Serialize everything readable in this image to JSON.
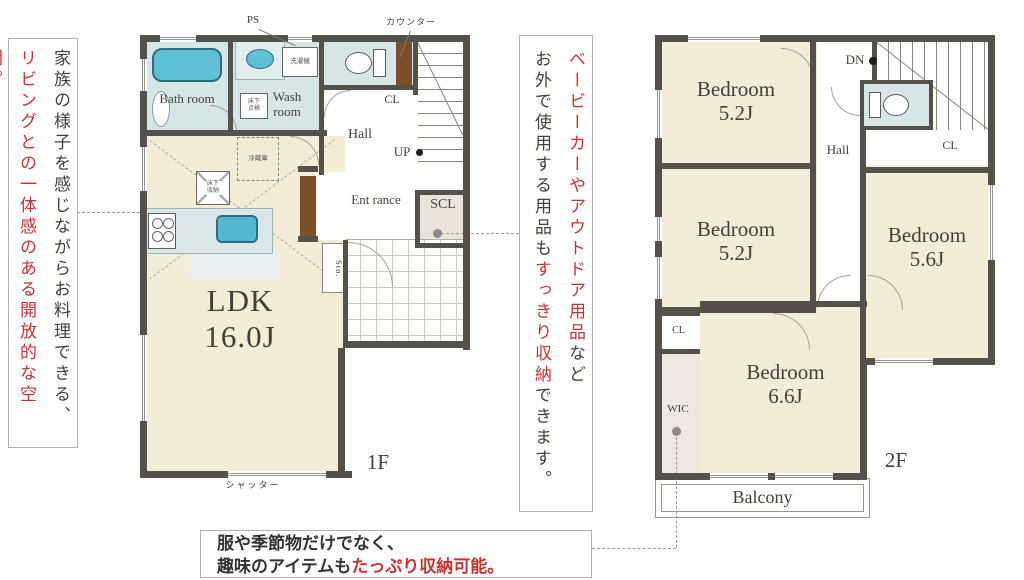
{
  "colors": {
    "wall": "#54504a",
    "room_beige": "#f3ecd7",
    "wet_area_blue": "#d6e5e6",
    "closet_beige": "#ece3d8",
    "fixture_teal": "#5ec1d6",
    "door_brown": "#7c4e2a",
    "accent_red": "#c53333"
  },
  "notes": {
    "left": {
      "black": "家族の様子を感じながらお料理できる、",
      "red": "リビングとの一体感のある開放的な空間。"
    },
    "middle": {
      "red1": "ベービーカーやアウトドア用品",
      "black1": "など",
      "black2": "お外で使用する用品も",
      "red2": "すっきり収納",
      "black3": "できます。"
    },
    "bottom": {
      "line1": "服や季節物だけでなく、",
      "line2_black": "趣味のアイテムも",
      "line2_red": "たっぷり収納可能。"
    }
  },
  "floor1": {
    "floor_label": "1F",
    "ps": "PS",
    "counter": "カウンター",
    "shutter": "シャッター",
    "bath": "Bath room",
    "wash": "Wash room",
    "washer": "洗濯機",
    "hatch": "床下点検",
    "cl": "CL",
    "hall": "Hall",
    "up": "UP",
    "entrance": "Ent rance",
    "scl": "SCL",
    "sto": "Sto.",
    "fridge": "冷蔵庫",
    "floor_storage": "床下収納",
    "ldk": "LDK",
    "ldk_size": "16.0J"
  },
  "floor2": {
    "floor_label": "2F",
    "dn": "DN",
    "hall": "Hall",
    "cl_top": "CL",
    "cl_left": "CL",
    "wic": "WIC",
    "balcony": "Balcony",
    "bed1_name": "Bedroom",
    "bed1_size": "5.2J",
    "bed2_name": "Bedroom",
    "bed2_size": "5.2J",
    "bed3_name": "Bedroom",
    "bed3_size": "5.6J",
    "bed4_name": "Bedroom",
    "bed4_size": "6.6J"
  }
}
